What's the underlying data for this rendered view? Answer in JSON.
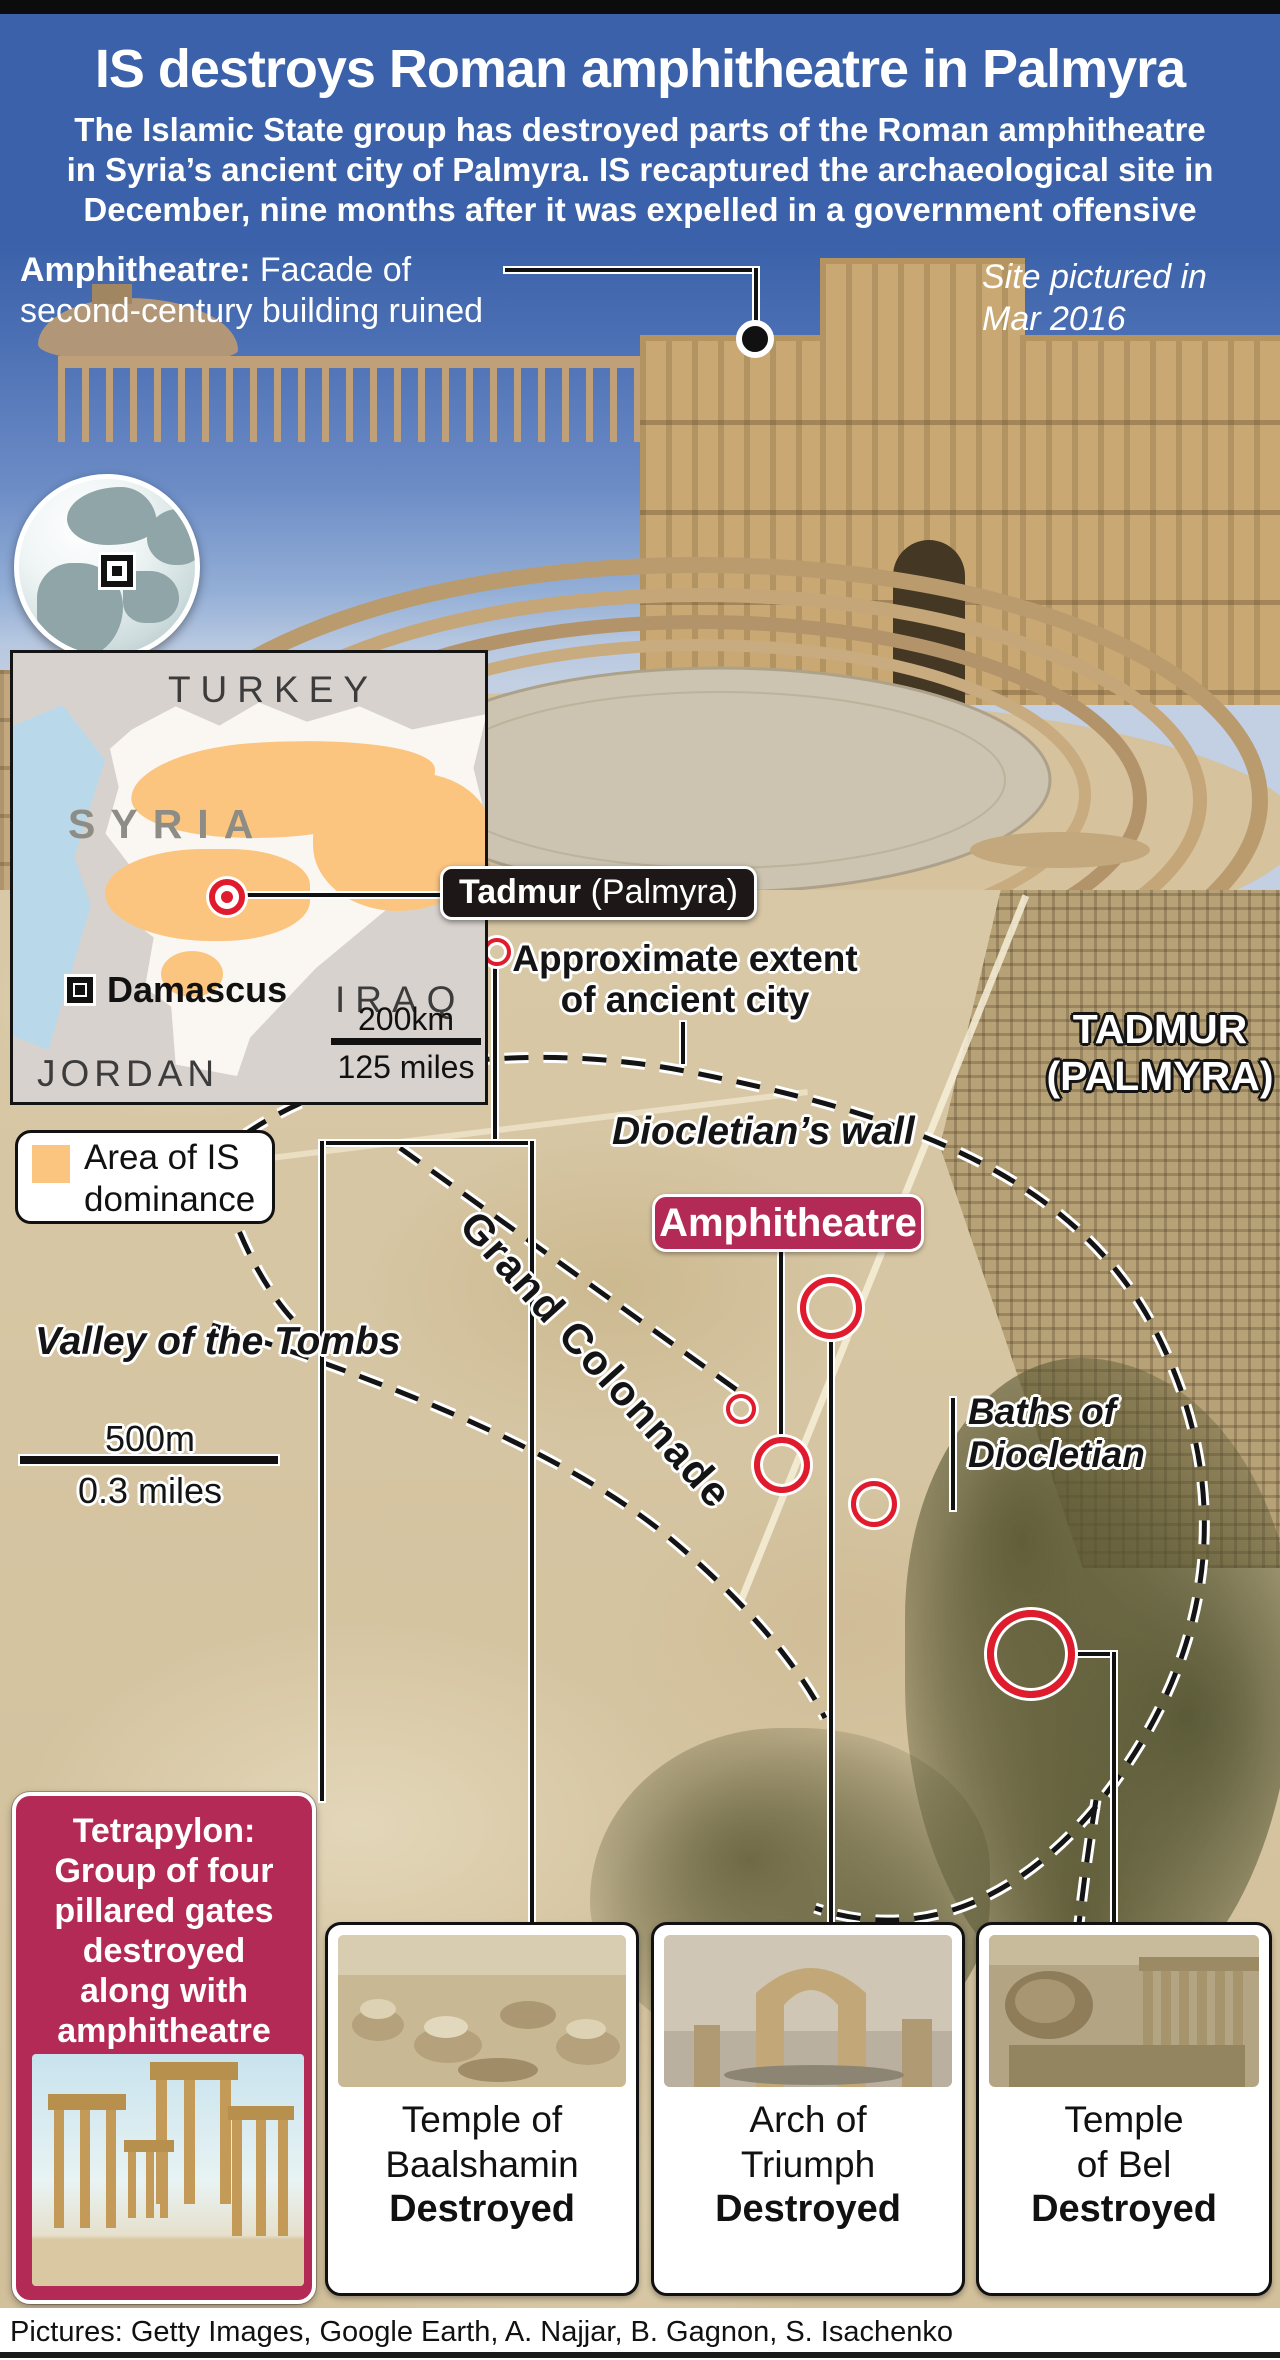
{
  "header": {
    "title": "IS destroys Roman amphitheatre in Palmyra",
    "subtitle_lines": [
      "The Islamic State group has destroyed parts of the Roman amphitheatre",
      "in Syria’s ancient city of Palmyra. IS recaptured the archaeological site in",
      "December, nine months after it was expelled in a government offensive"
    ]
  },
  "photo": {
    "annotation_bold": "Amphitheatre:",
    "annotation_line1_rest": " Facade of",
    "annotation_line2": "second-century building ruined",
    "caption_line1": "Site pictured in",
    "caption_line2": "Mar 2016"
  },
  "locator_map": {
    "turkey": "TURKEY",
    "syria": "SYRIA",
    "iraq": "IRAQ",
    "jordan": "JORDAN",
    "capital": "Damascus",
    "city_bold": "Tadmur",
    "city_rest": " (Palmyra)",
    "scale_top": "200km",
    "scale_bottom": "125 miles"
  },
  "legend": {
    "line1": "Area of IS",
    "line2": "dominance"
  },
  "satellite_map": {
    "extent_line1": "Approximate extent",
    "extent_line2": "of ancient city",
    "city_line1": "TADMUR",
    "city_line2": "(PALMYRA)",
    "wall_label": "Diocletian’s wall",
    "amphitheatre_badge": "Amphitheatre",
    "colonnade_label": "Grand Colonnade",
    "valley_label": "Valley of the Tombs",
    "baths_line1": "Baths of",
    "baths_line2": "Diocletian",
    "scale_top": "500m",
    "scale_bottom": "0.3 miles"
  },
  "tetrapylon": {
    "lines": [
      "Tetrapylon:",
      "Group of four",
      "pillared gates",
      "destroyed",
      "along with",
      "amphitheatre"
    ]
  },
  "sites": [
    {
      "name_line1": "Temple of",
      "name_line2": "Baalshamin",
      "status": "Destroyed"
    },
    {
      "name_line1": "Arch of",
      "name_line2": "Triumph",
      "status": "Destroyed"
    },
    {
      "name_line1": "Temple",
      "name_line2": "of Bel",
      "status": "Destroyed"
    }
  ],
  "credits": {
    "text": "Pictures: Getty Images, Google Earth, A. Najjar, B. Gagnon, S. Isachenko"
  },
  "colors": {
    "header_blue": "#3a61a9",
    "panel_crimson": "#b42a56",
    "is_area_orange": "#fbc580",
    "ring_red": "#e01b2e"
  }
}
